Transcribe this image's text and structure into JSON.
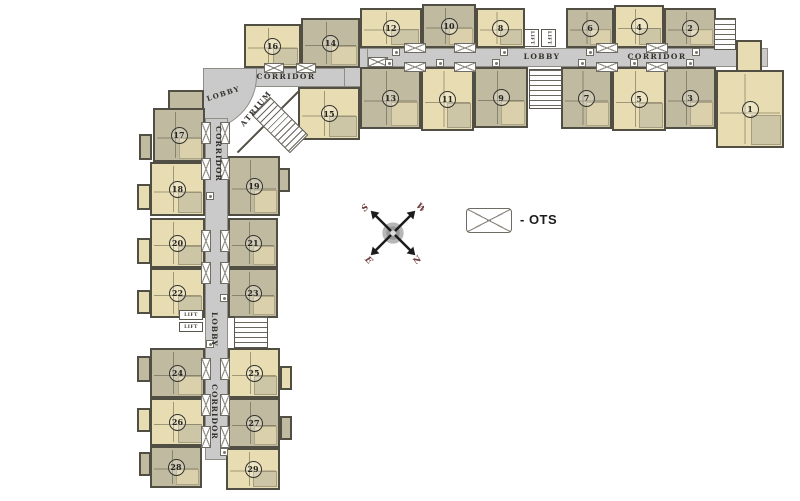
{
  "plan": {
    "type": "residential-floor-plan",
    "unit_count": 29
  },
  "labels": {
    "corridor": "CORRIDOR",
    "lobby": "LOBBY",
    "atrium": "ATRIUM",
    "lift": "LIFT"
  },
  "legend": {
    "symbol": "crossed-box",
    "label": "- OTS"
  },
  "compass": {
    "north": "N",
    "south": "S",
    "east": "E",
    "west": "W"
  },
  "units": [
    "1",
    "2",
    "3",
    "4",
    "5",
    "6",
    "7",
    "8",
    "9",
    "10",
    "11",
    "12",
    "13",
    "14",
    "15",
    "16",
    "17",
    "18",
    "19",
    "20",
    "21",
    "22",
    "23",
    "24",
    "25",
    "26",
    "27",
    "28",
    "29"
  ],
  "colors": {
    "unit_tan": "#e8ddb2",
    "unit_olive": "#bfbaa0",
    "corridor_grey": "#cacaca",
    "wall": "#514e44",
    "compass_letters": "#6d3c3c"
  }
}
